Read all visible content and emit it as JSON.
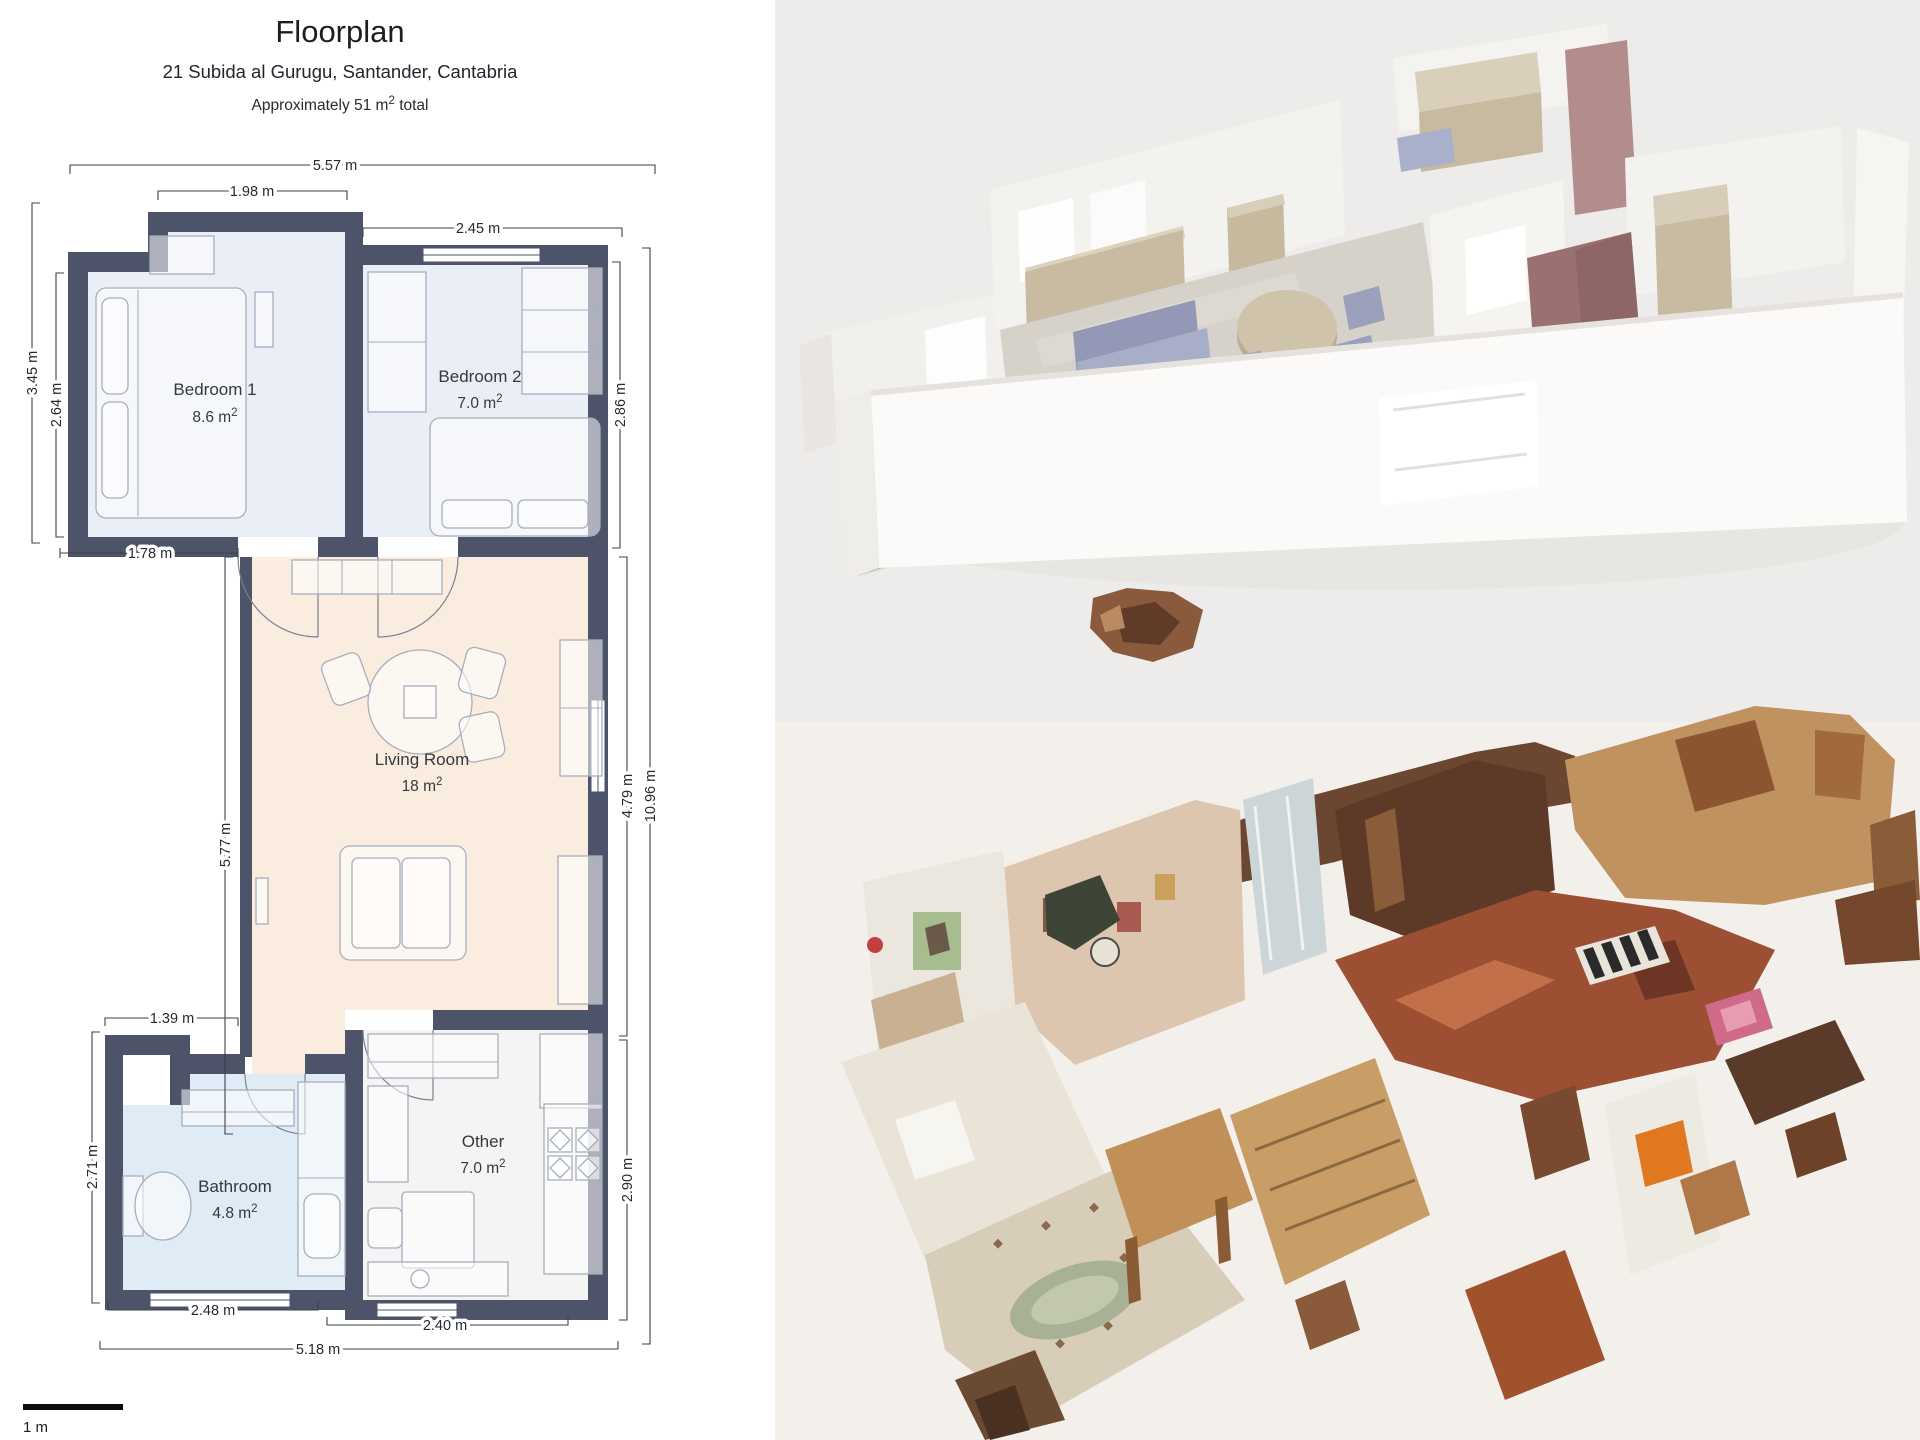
{
  "floorplan": {
    "title": "Floorplan",
    "address": "21 Subida al Gurugu, Santander, Cantabria",
    "area_note": {
      "prefix": "Approximately 51 m",
      "sup": "2",
      "suffix": " total"
    },
    "scale_label": "1 m",
    "rooms": {
      "bedroom1": {
        "name": "Bedroom 1",
        "area": "8.6 m",
        "sup": "2"
      },
      "bedroom2": {
        "name": "Bedroom 2",
        "area": "7.0 m",
        "sup": "2"
      },
      "living": {
        "name": "Living Room",
        "area": "18 m",
        "sup": "2"
      },
      "bathroom": {
        "name": "Bathroom",
        "area": "4.8 m",
        "sup": "2"
      },
      "other": {
        "name": "Other",
        "area": "7.0 m",
        "sup": "2"
      }
    },
    "dimensions": {
      "top_outer": "5.57 m",
      "top_bedroom1": "1.98 m",
      "top_bedroom2": "2.45 m",
      "left_outer": "3.45 m",
      "left_bedroom1": "2.64 m",
      "bedroom1_bottom": "1.78 m",
      "hall_left": "5.77 m",
      "bathroom_top": "1.39 m",
      "bathroom_left": "2.71 m",
      "right_bedroom2": "2.86 m",
      "right_living": "4.79 m",
      "right_other": "2.90 m",
      "right_outer": "10.96 m",
      "bottom_bathroom": "2.48 m",
      "bottom_other": "2.40 m",
      "bottom_outer": "5.18 m"
    }
  },
  "colors": {
    "wall": "#4d5369",
    "bedroom-fill": "#eaeef7",
    "living-fill": "#faeddf",
    "bathroom-fill": "#dfecf6",
    "other-fill": "#f4f4f5",
    "render-bg": "#edecea",
    "scan-bg": "#f3f0ec",
    "accent-mauve": "#b28d8b",
    "accent-beige": "#c8bba1",
    "accent-lavender": "#a8aec8"
  }
}
